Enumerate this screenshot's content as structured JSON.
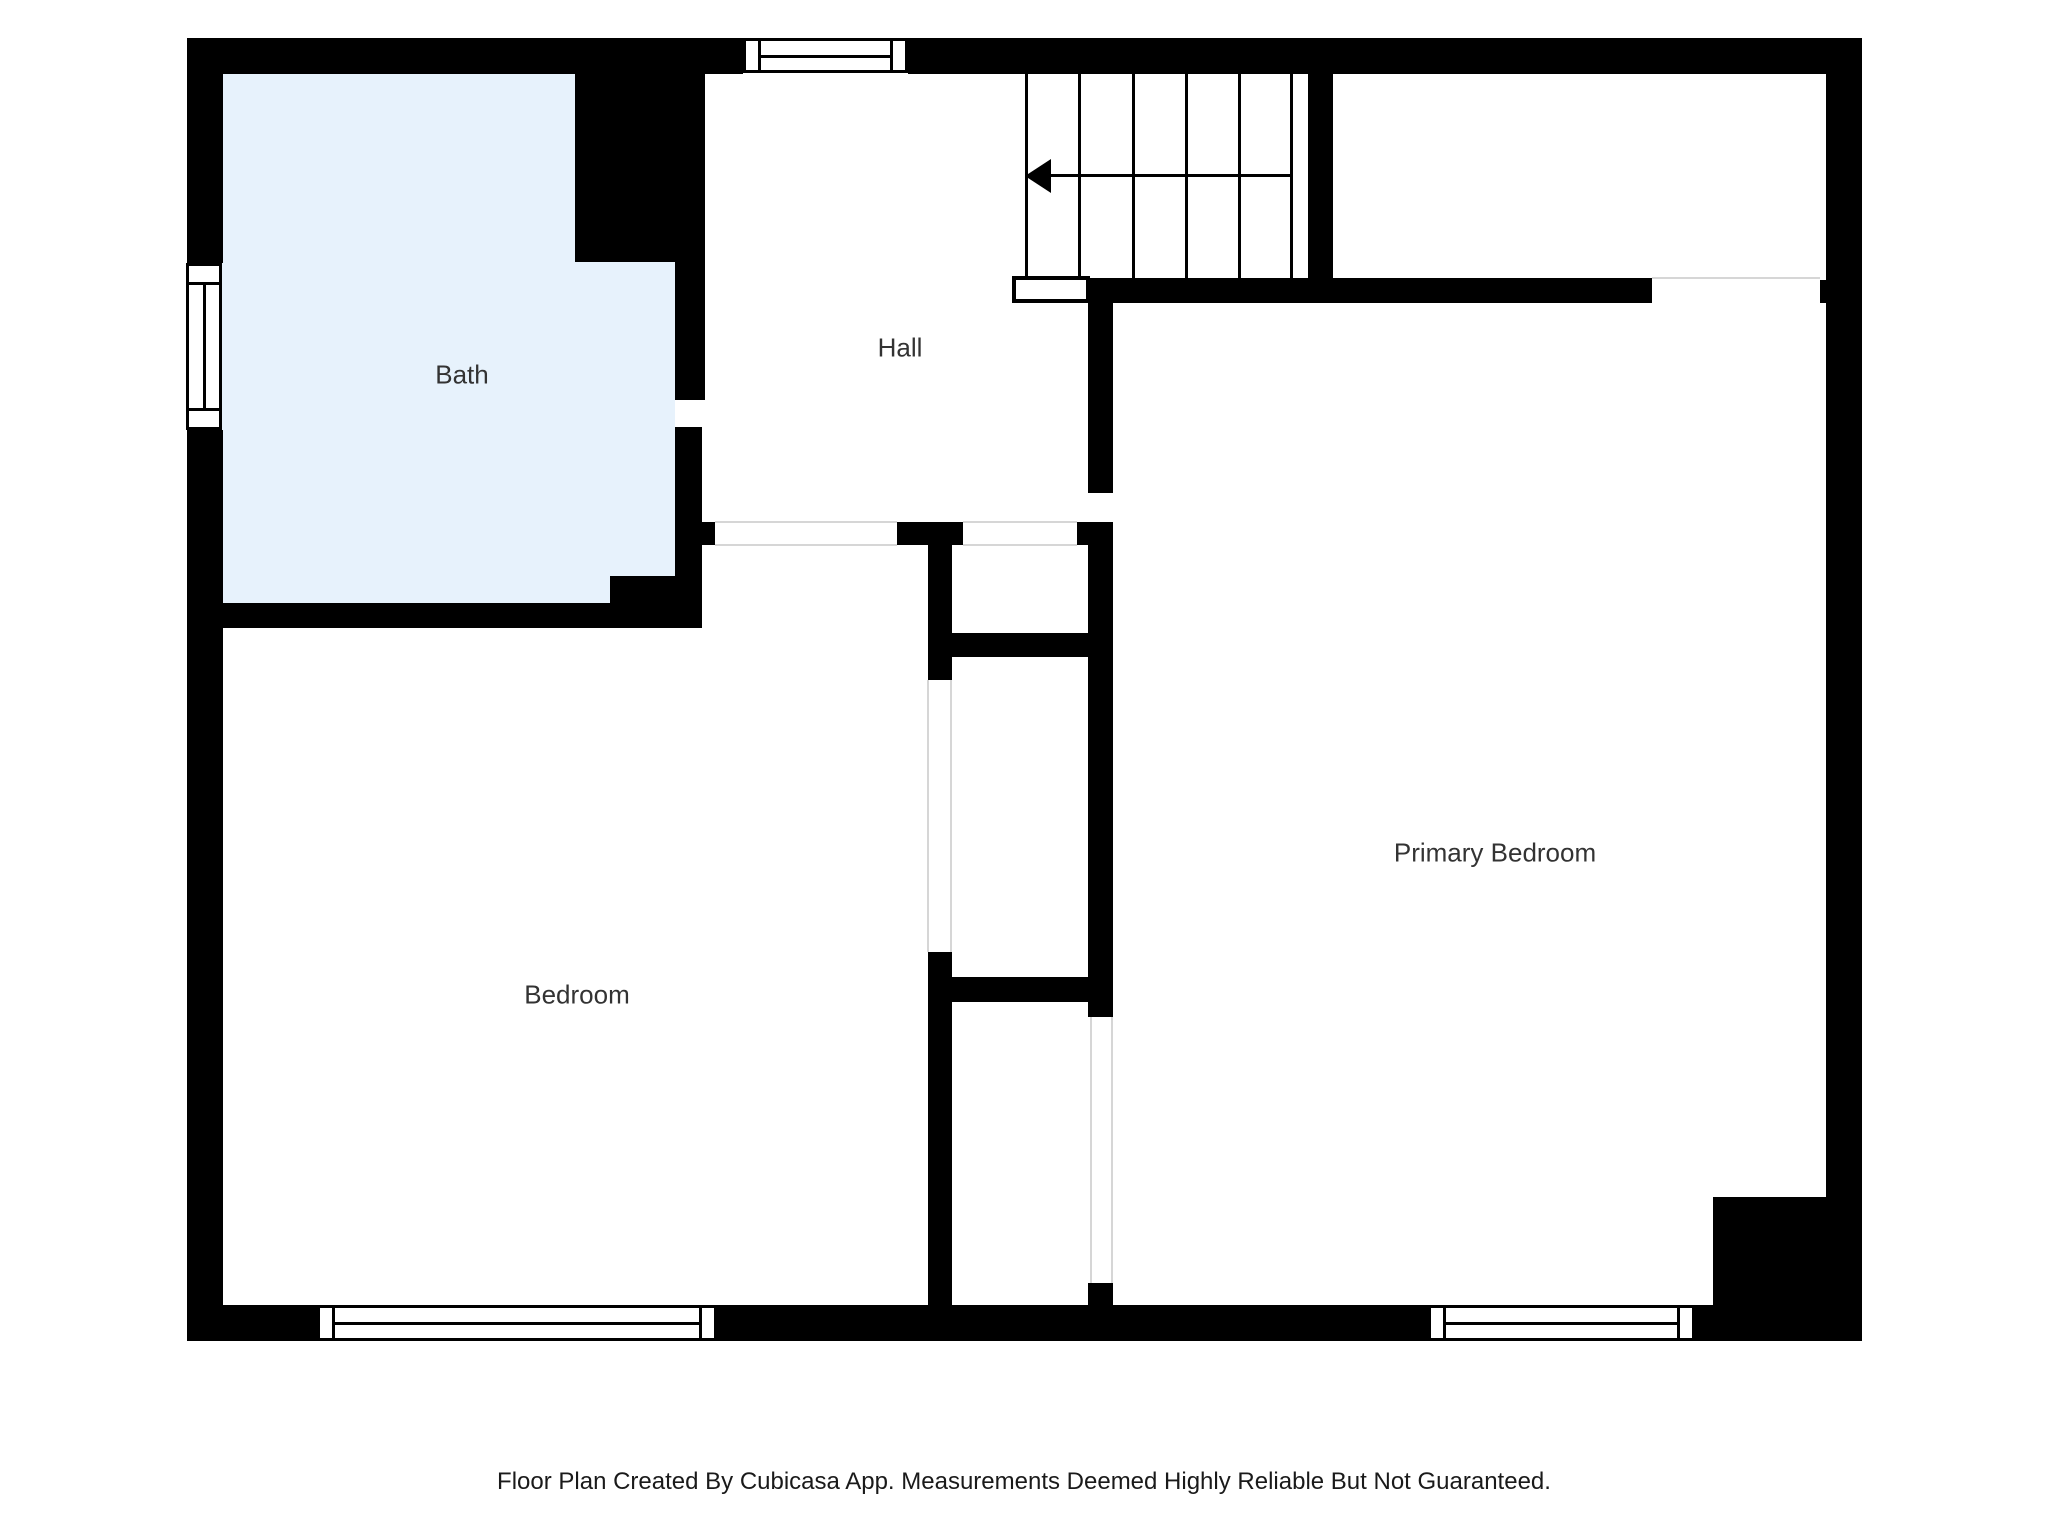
{
  "rooms": {
    "bath": {
      "label": "Bath"
    },
    "hall": {
      "label": "Hall"
    },
    "bedroom": {
      "label": "Bedroom"
    },
    "primary_bedroom": {
      "label": "Primary Bedroom"
    }
  },
  "stairs": {
    "direction_icon": "arrow-left",
    "tread_count": 5
  },
  "caption": "Floor Plan Created By Cubicasa App. Measurements Deemed Highly Reliable But Not Guaranteed.",
  "colors": {
    "wall": "#000000",
    "bath_floor": "#e7f2fc",
    "opening_line": "#d6d6d6",
    "label_text": "#333333",
    "caption_text": "#1a1a1a"
  }
}
